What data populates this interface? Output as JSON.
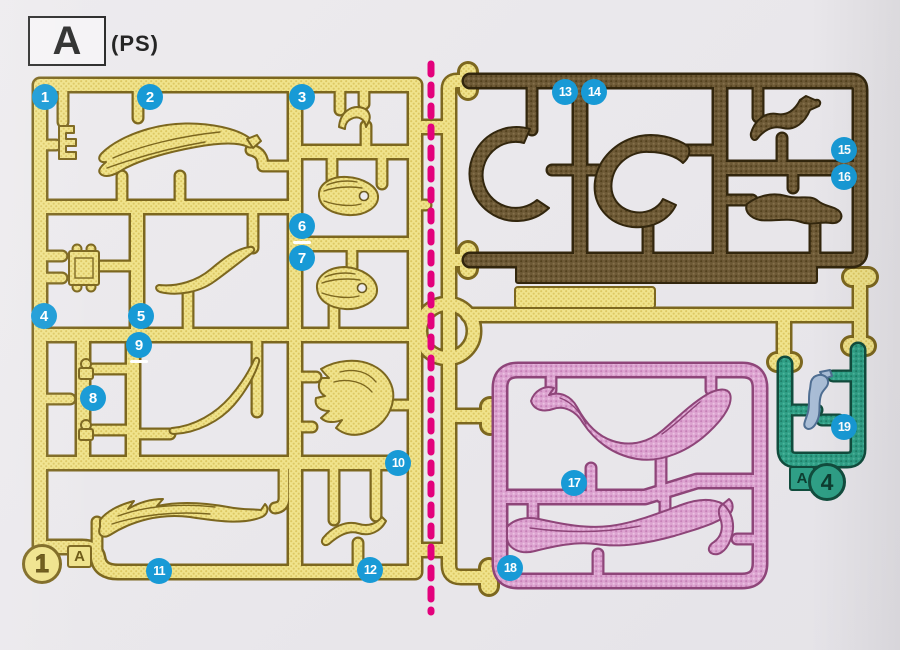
{
  "header": {
    "runner_letter": "A",
    "material_code": "(PS)"
  },
  "main_runner_mark": {
    "number": "1",
    "letter": "A"
  },
  "small_runner_mark": {
    "letter": "A",
    "number": "4"
  },
  "part_badges": [
    {
      "label": "1",
      "x": 45,
      "y": 97,
      "underline": false
    },
    {
      "label": "2",
      "x": 150,
      "y": 97,
      "underline": false
    },
    {
      "label": "3",
      "x": 302,
      "y": 97,
      "underline": false
    },
    {
      "label": "4",
      "x": 44,
      "y": 316,
      "underline": false
    },
    {
      "label": "5",
      "x": 141,
      "y": 316,
      "underline": false
    },
    {
      "label": "6",
      "x": 302,
      "y": 226,
      "underline": true
    },
    {
      "label": "7",
      "x": 302,
      "y": 258,
      "underline": false
    },
    {
      "label": "8",
      "x": 93,
      "y": 398,
      "underline": false
    },
    {
      "label": "9",
      "x": 139,
      "y": 345,
      "underline": true
    },
    {
      "label": "10",
      "x": 398,
      "y": 463,
      "underline": false
    },
    {
      "label": "11",
      "x": 159,
      "y": 571,
      "underline": false
    },
    {
      "label": "12",
      "x": 370,
      "y": 570,
      "underline": false
    },
    {
      "label": "13",
      "x": 565,
      "y": 92,
      "underline": false
    },
    {
      "label": "14",
      "x": 594,
      "y": 92,
      "underline": false
    },
    {
      "label": "15",
      "x": 844,
      "y": 150,
      "underline": false
    },
    {
      "label": "16",
      "x": 844,
      "y": 177,
      "underline": false
    },
    {
      "label": "17",
      "x": 574,
      "y": 483,
      "underline": false
    },
    {
      "label": "18",
      "x": 510,
      "y": 568,
      "underline": false
    },
    {
      "label": "19",
      "x": 844,
      "y": 427,
      "underline": false
    }
  ],
  "colors": {
    "background": "#e9e7eb",
    "badge_blue": "#189ad6",
    "separator_magenta": "#e3017c",
    "runner_yellow": "#efe28a",
    "runner_brown": "#6d5936",
    "runner_pink": "#dca3d0",
    "runner_teal": "#2f9f86",
    "part19_blue_grey": "#a9bdd6"
  },
  "separator": {
    "orientation": "vertical",
    "style": "dashed"
  }
}
